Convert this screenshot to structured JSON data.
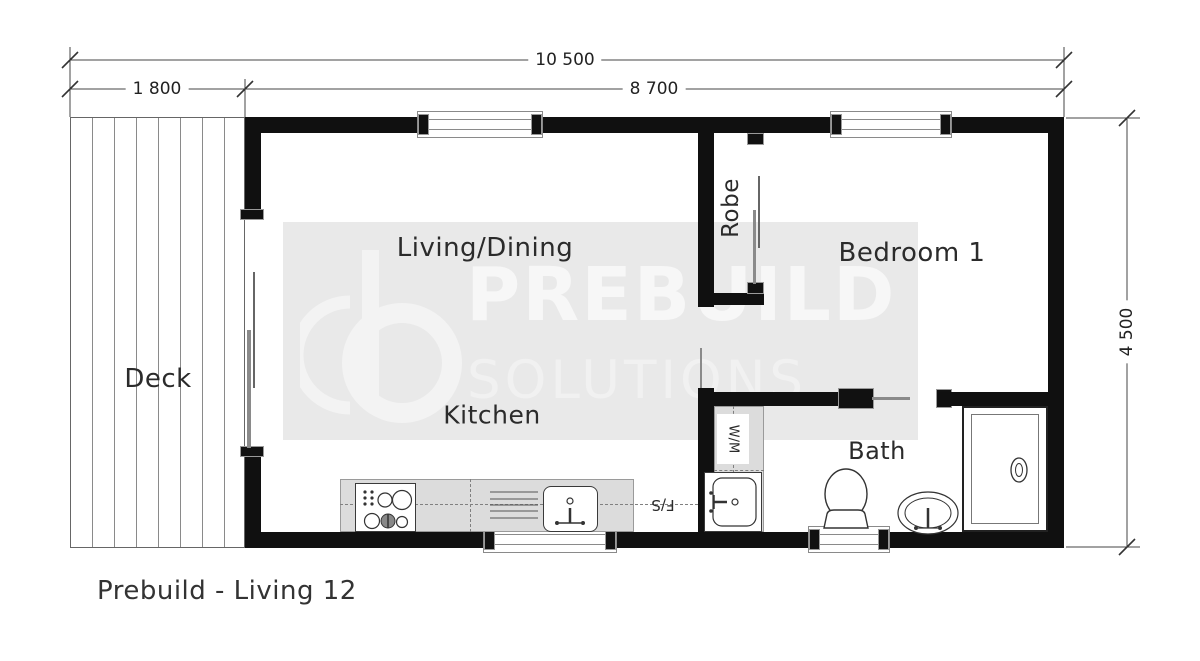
{
  "title": "Prebuild - Living 12",
  "rooms": {
    "deck": "Deck",
    "living": "Living/Dining",
    "kitchen": "Kitchen",
    "bedroom": "Bedroom 1",
    "robe": "Robe",
    "bath": "Bath",
    "washing_machine": "W/M",
    "fridge_space": "F/S"
  },
  "dims": {
    "overall_width": "10 500",
    "deck_width": "1 800",
    "building_width": "8 700",
    "depth": "4 500"
  },
  "watermark": {
    "brand": "PREBUILD",
    "sub": "SOLUTIONS"
  },
  "colors": {
    "wall": "#101010",
    "counter": "#dcdcdc",
    "watermark_bg": "#e9e9e9",
    "line": "#444444"
  }
}
